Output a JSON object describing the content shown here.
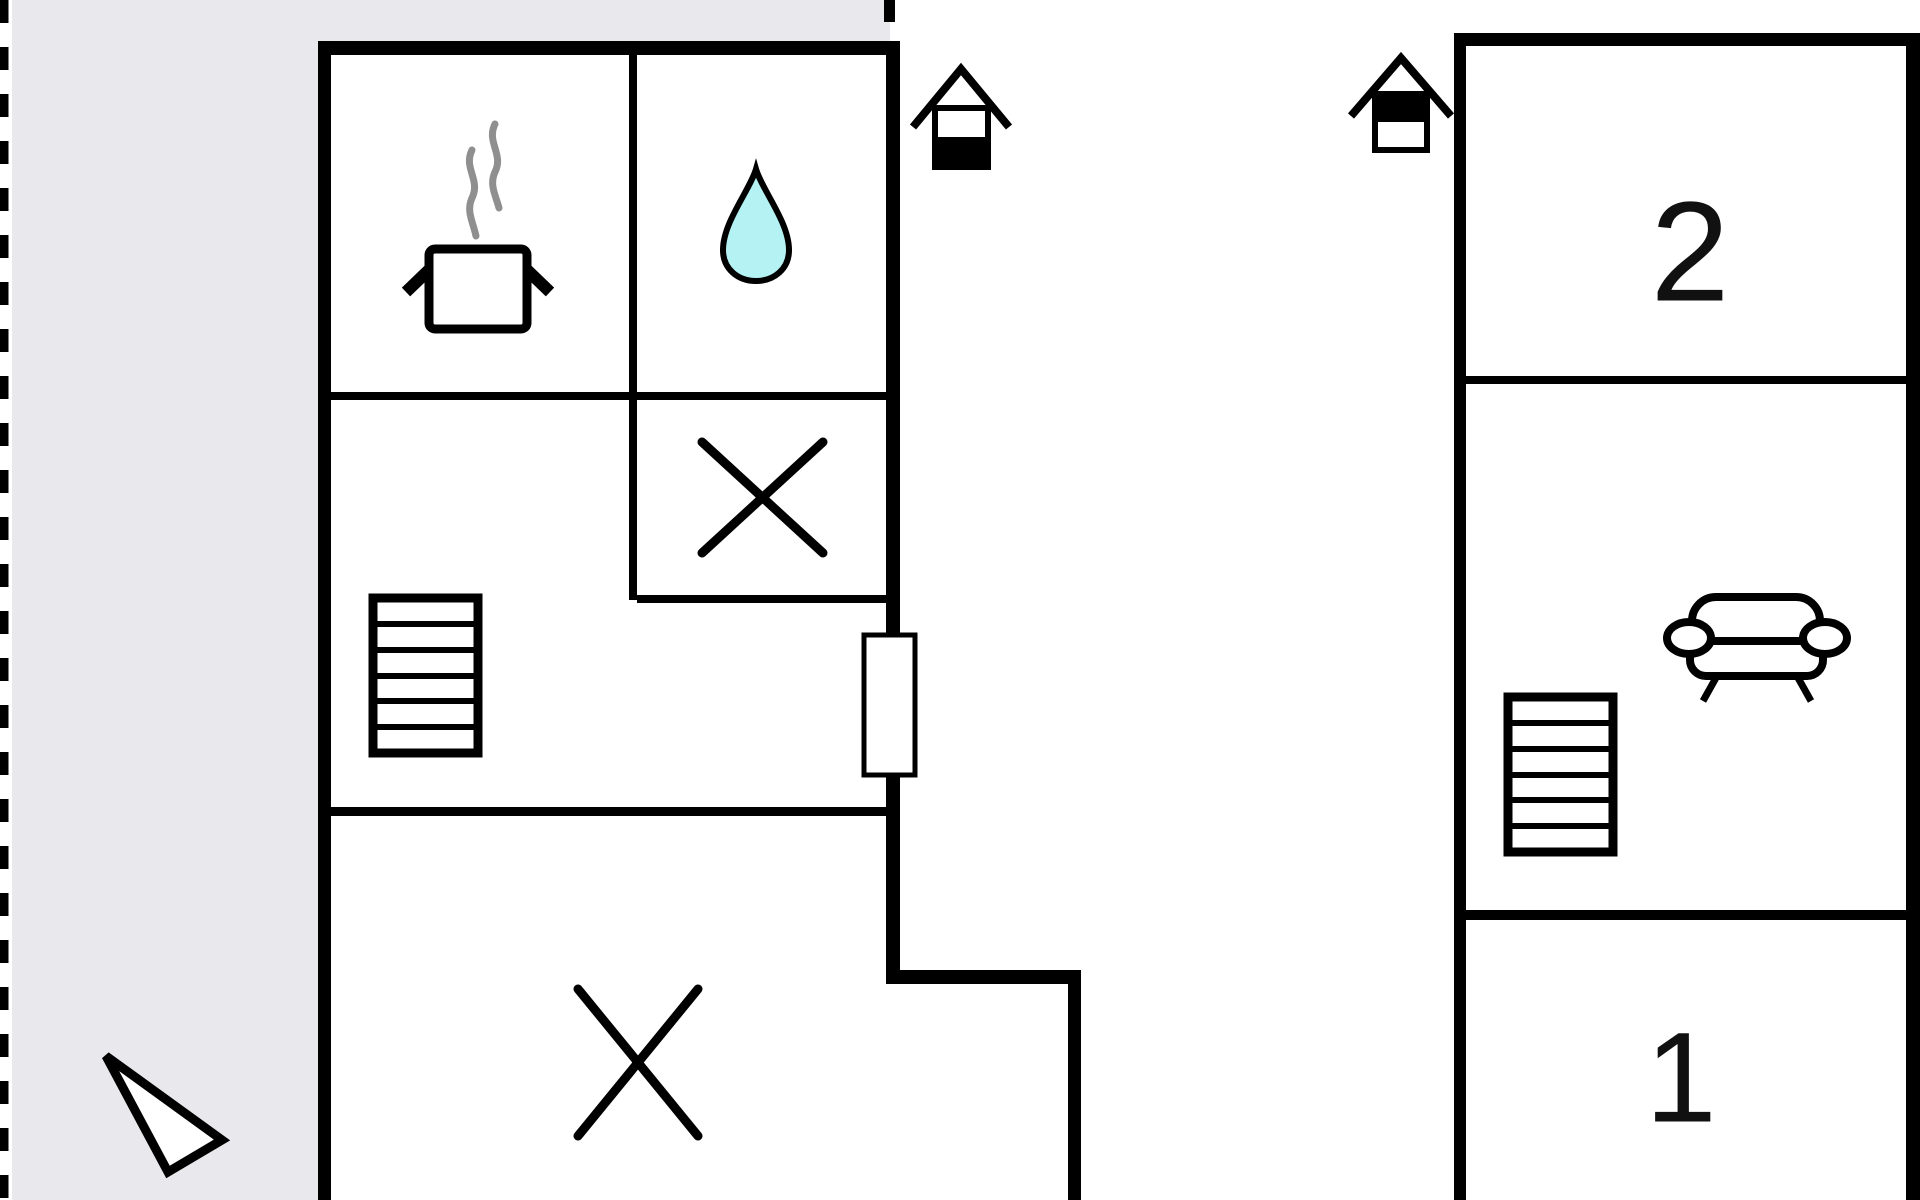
{
  "page": {
    "title": "Holiday home floor plan",
    "background": "#ffffff"
  },
  "colors": {
    "wall": "#000000",
    "outside_area": "#e9e8ed",
    "water_drop": "#b5f2f4",
    "steam": "#8f8f8f",
    "ink": "#111111"
  },
  "left_plan": {
    "name": "ground-floor-plan",
    "rooms": [
      {
        "name": "kitchen",
        "icon": "cooking-pot-icon"
      },
      {
        "name": "bathroom",
        "icon": "water-drop-icon"
      },
      {
        "name": "toilet",
        "icon": "cross-marker-icon"
      },
      {
        "name": "hall",
        "icon": "stairs-icon"
      },
      {
        "name": "large-room",
        "icon": "cross-marker-icon"
      }
    ],
    "door_count": 1
  },
  "right_plan": {
    "name": "upper-floor-plan",
    "rooms": [
      {
        "name": "bedroom-2",
        "label": "2"
      },
      {
        "name": "landing",
        "icons": [
          "sofa-icon",
          "stairs-icon"
        ]
      },
      {
        "name": "bedroom-1",
        "label": "1"
      }
    ]
  },
  "floor_indicators": [
    {
      "name": "ground-floor-indicator",
      "filled_half": "bottom"
    },
    {
      "name": "upper-floor-indicator",
      "filled_half": "top"
    }
  ],
  "compass": {
    "name": "direction-arrow"
  }
}
